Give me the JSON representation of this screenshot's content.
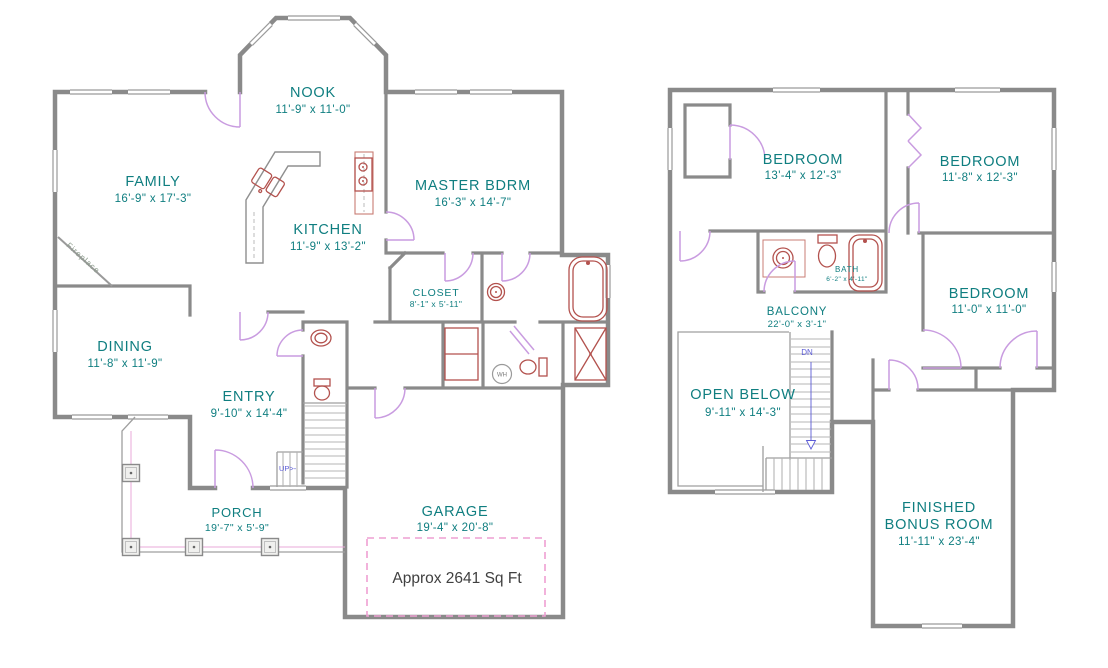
{
  "colors": {
    "label_teal": "#0f7e80",
    "wall_gray": "#8a8a8a",
    "fixture_red": "#b3524e",
    "door_purple": "#c99ce0",
    "dash_pink": "#ee9fd2",
    "stair_blue": "#5b5bd6",
    "area_text_gray": "#404040",
    "fireplace_text": "#8a9a8a"
  },
  "first_floor": {
    "rooms": [
      {
        "name": "NOOK",
        "dims": "11'-9\" x 11'-0\""
      },
      {
        "name": "FAMILY",
        "dims": "16'-9\" x 17'-3\""
      },
      {
        "name": "KITCHEN",
        "dims": "11'-9\" x 13'-2\""
      },
      {
        "name": "MASTER BDRM",
        "dims": "16'-3\" x 14'-7\""
      },
      {
        "name": "CLOSET",
        "dims": "8'-1\" x 5'-11\""
      },
      {
        "name": "DINING",
        "dims": "11'-8\" x 11'-9\""
      },
      {
        "name": "ENTRY",
        "dims": "9'-10\" x 14'-4\""
      },
      {
        "name": "PORCH",
        "dims": "19'-7\" x 5'-9\""
      },
      {
        "name": "GARAGE",
        "dims": "19'-4\" x 20'-8\""
      }
    ],
    "annotations": {
      "area": "Approx 2641  Sq Ft",
      "stairs_up": "UP>-",
      "water_heater": "WH",
      "fireplace": "Fireplace"
    }
  },
  "second_floor": {
    "rooms": [
      {
        "name": "BEDROOM",
        "dims": "13'-4\" x 12'-3\""
      },
      {
        "name": "BEDROOM",
        "dims": "11'-8\" x 12'-3\""
      },
      {
        "name": "BATH",
        "dims": "6'-2\" x 4'-11\""
      },
      {
        "name": "BEDROOM",
        "dims": "11'-0\" x 11'-0\""
      },
      {
        "name": "BALCONY",
        "dims": "22'-0\" x 3'-1\""
      },
      {
        "name": "OPEN BELOW",
        "dims": "9'-11\" x 14'-3\""
      },
      {
        "name": "FINISHED BONUS ROOM",
        "lines": [
          "FINISHED",
          "BONUS ROOM"
        ],
        "dims": "11'-11\" x 23'-4\""
      }
    ],
    "annotations": {
      "stairs_down": "DN"
    }
  }
}
